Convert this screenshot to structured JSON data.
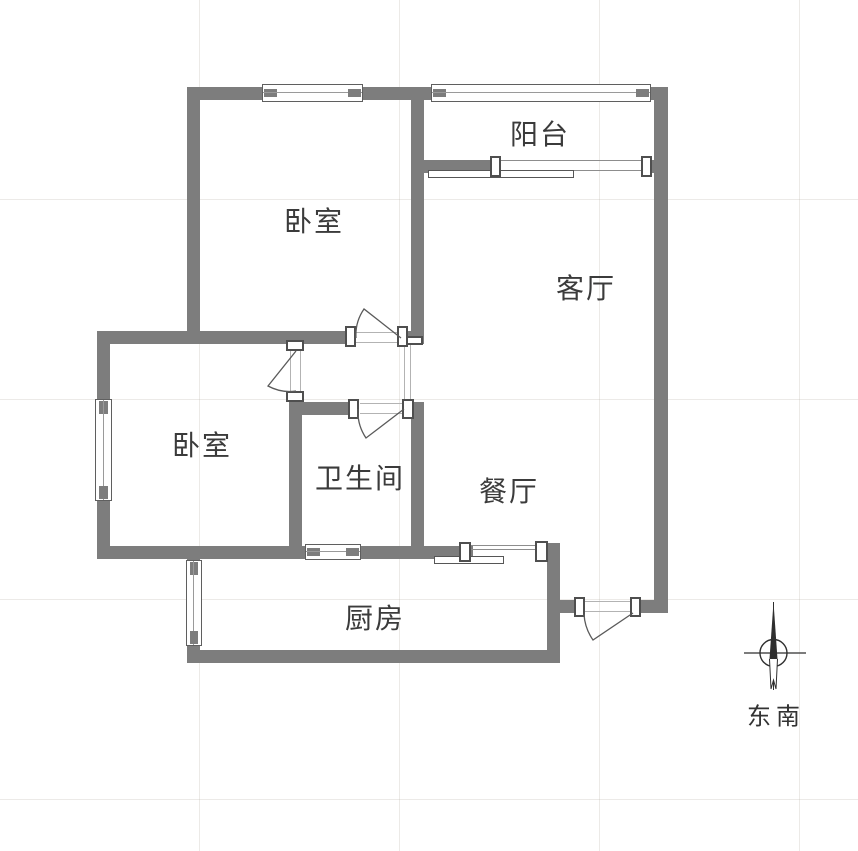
{
  "figure": {
    "kind": "apartment-floor-plan"
  },
  "rooms": [
    {
      "name": "balcony",
      "label": "阳台"
    },
    {
      "name": "bedroom-top",
      "label": "卧室"
    },
    {
      "name": "living-room",
      "label": "客厅"
    },
    {
      "name": "bedroom-left",
      "label": "卧室"
    },
    {
      "name": "bathroom",
      "label": "卫生间"
    },
    {
      "name": "dining-room",
      "label": "餐厅"
    },
    {
      "name": "kitchen",
      "label": "厨房"
    }
  ],
  "compass": {
    "direction_label": "东南"
  },
  "colors": {
    "wall": "#7d7d7d",
    "line": "#5a5a5a",
    "text": "#3b3b3b",
    "grid": "#e9e6e1",
    "background": "#ffffff"
  }
}
